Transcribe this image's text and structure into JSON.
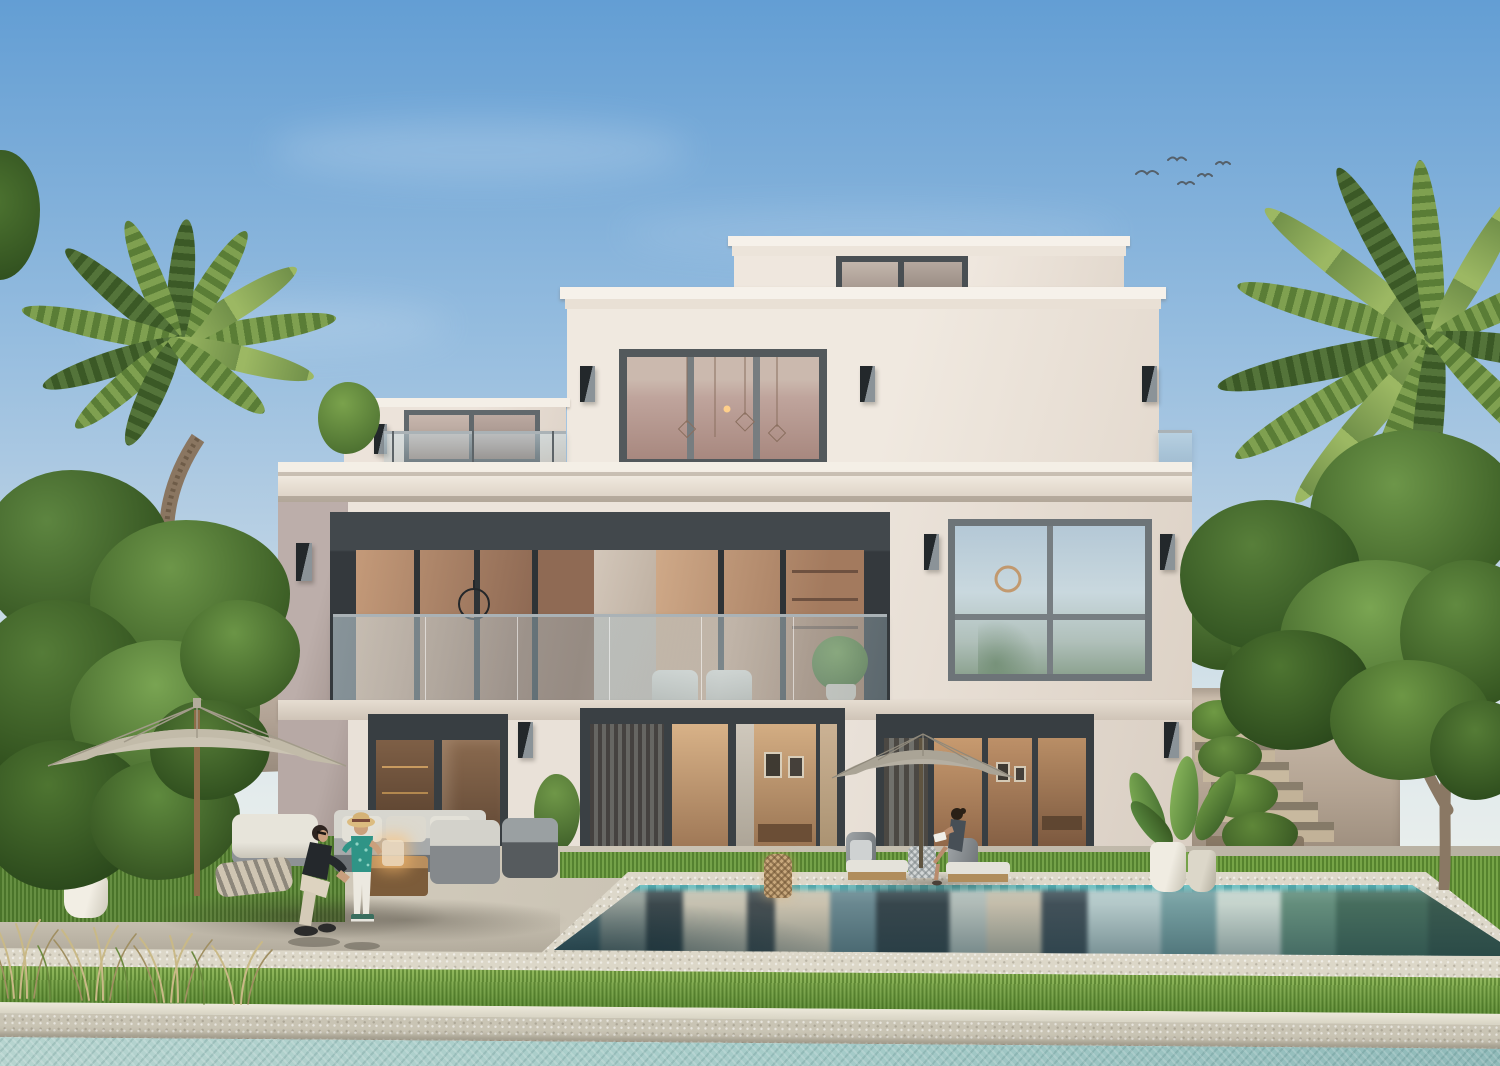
{
  "scene": {
    "type": "architectural exterior rendering",
    "subject": "rear elevation of a modern three-storey villa with pool garden",
    "sky": {
      "condition": "clear with faint wispy clouds",
      "birds": 5
    },
    "building": {
      "storeys": 3,
      "roof_box_window": 1,
      "top_floor_window_panes": 3,
      "middle_floor": "recessed balcony with frameless glass balustrade and large glazing",
      "middle_floor_right_window_grid": "2x2",
      "ground_floor_door_sets": 3,
      "wall_sconces": 10,
      "left_wing": "set-back volume with terrace, glass railing and small tree"
    },
    "landscape": {
      "palms": 2,
      "large_trees": 2,
      "garden_walls": 2,
      "right_side": "planted staircase ascending beside villa",
      "planters": [
        "white pot on lawn",
        "two pots with bird-of-paradise plants",
        "dark planter at facade pier"
      ],
      "dry_ornamental_grasses": "bottom left corner"
    },
    "pool": {
      "shape": "rectangular, seen in perspective",
      "waterline_tile": "teal mosaic",
      "reflections": "facade and sky mirrored vertically"
    },
    "foreground": {
      "bands_bottom_to_top": [
        "canal water",
        "stone canal edge",
        "grass strip",
        "light stone walkway"
      ]
    },
    "furniture": {
      "umbrellas": 2,
      "left_group": [
        "white armchair",
        "floor cushion",
        "grey sofa",
        "wood coffee table with glowing lantern",
        "two armchairs"
      ],
      "pool_side": [
        "two chaise lounges with white cushions",
        "rattan drum side table",
        "wicker floor lantern"
      ],
      "balcony": [
        "two light armchairs",
        "potted plant"
      ]
    },
    "people": [
      {
        "who": "man",
        "pose": "crouching, playing with child",
        "clothing": "black t-shirt, beige trousers"
      },
      {
        "who": "child",
        "pose": "standing facing man",
        "clothing": "straw hat, teal tropical shirt, white trousers"
      },
      {
        "who": "woman",
        "pose": "sitting on chaise reading a book",
        "clothing": "dark slate dress"
      }
    ]
  },
  "palette": {
    "sky_top": "#639ed4",
    "sky_horizon": "#eef1ec",
    "facade_cream": "#efe8df",
    "facade_shadow": "#dcd2c7",
    "facade_mauve": "#b2a4a0",
    "cornice_white": "#f5f0e8",
    "frame_dark": "#3c4246",
    "frame_gray": "#6a7175",
    "glass_warm": "#b98e6e",
    "glass_blue": "#b9cdd8",
    "pool_dark": "#3c5a60",
    "pool_teal": "#6fa0a4",
    "pool_tile": "#3aa3a8",
    "canal_water": "#a9cdca",
    "grass_green": "#71a23f",
    "grass_dark": "#4f7c2c",
    "patio_gravel": "#c9c2b3",
    "stone_edge": "#d9d4c5",
    "umbrella_left": "#c9c2b1",
    "umbrella_right": "#b2aca0",
    "foliage": "#4c7231",
    "foliage_dark": "#2f501f",
    "palm_green": "#78994a",
    "trunk_brown": "#8a7661",
    "garden_wall": "#c3b4a8",
    "cushion_white": "#dcdad2",
    "lantern_amber": "#e8a45e"
  }
}
